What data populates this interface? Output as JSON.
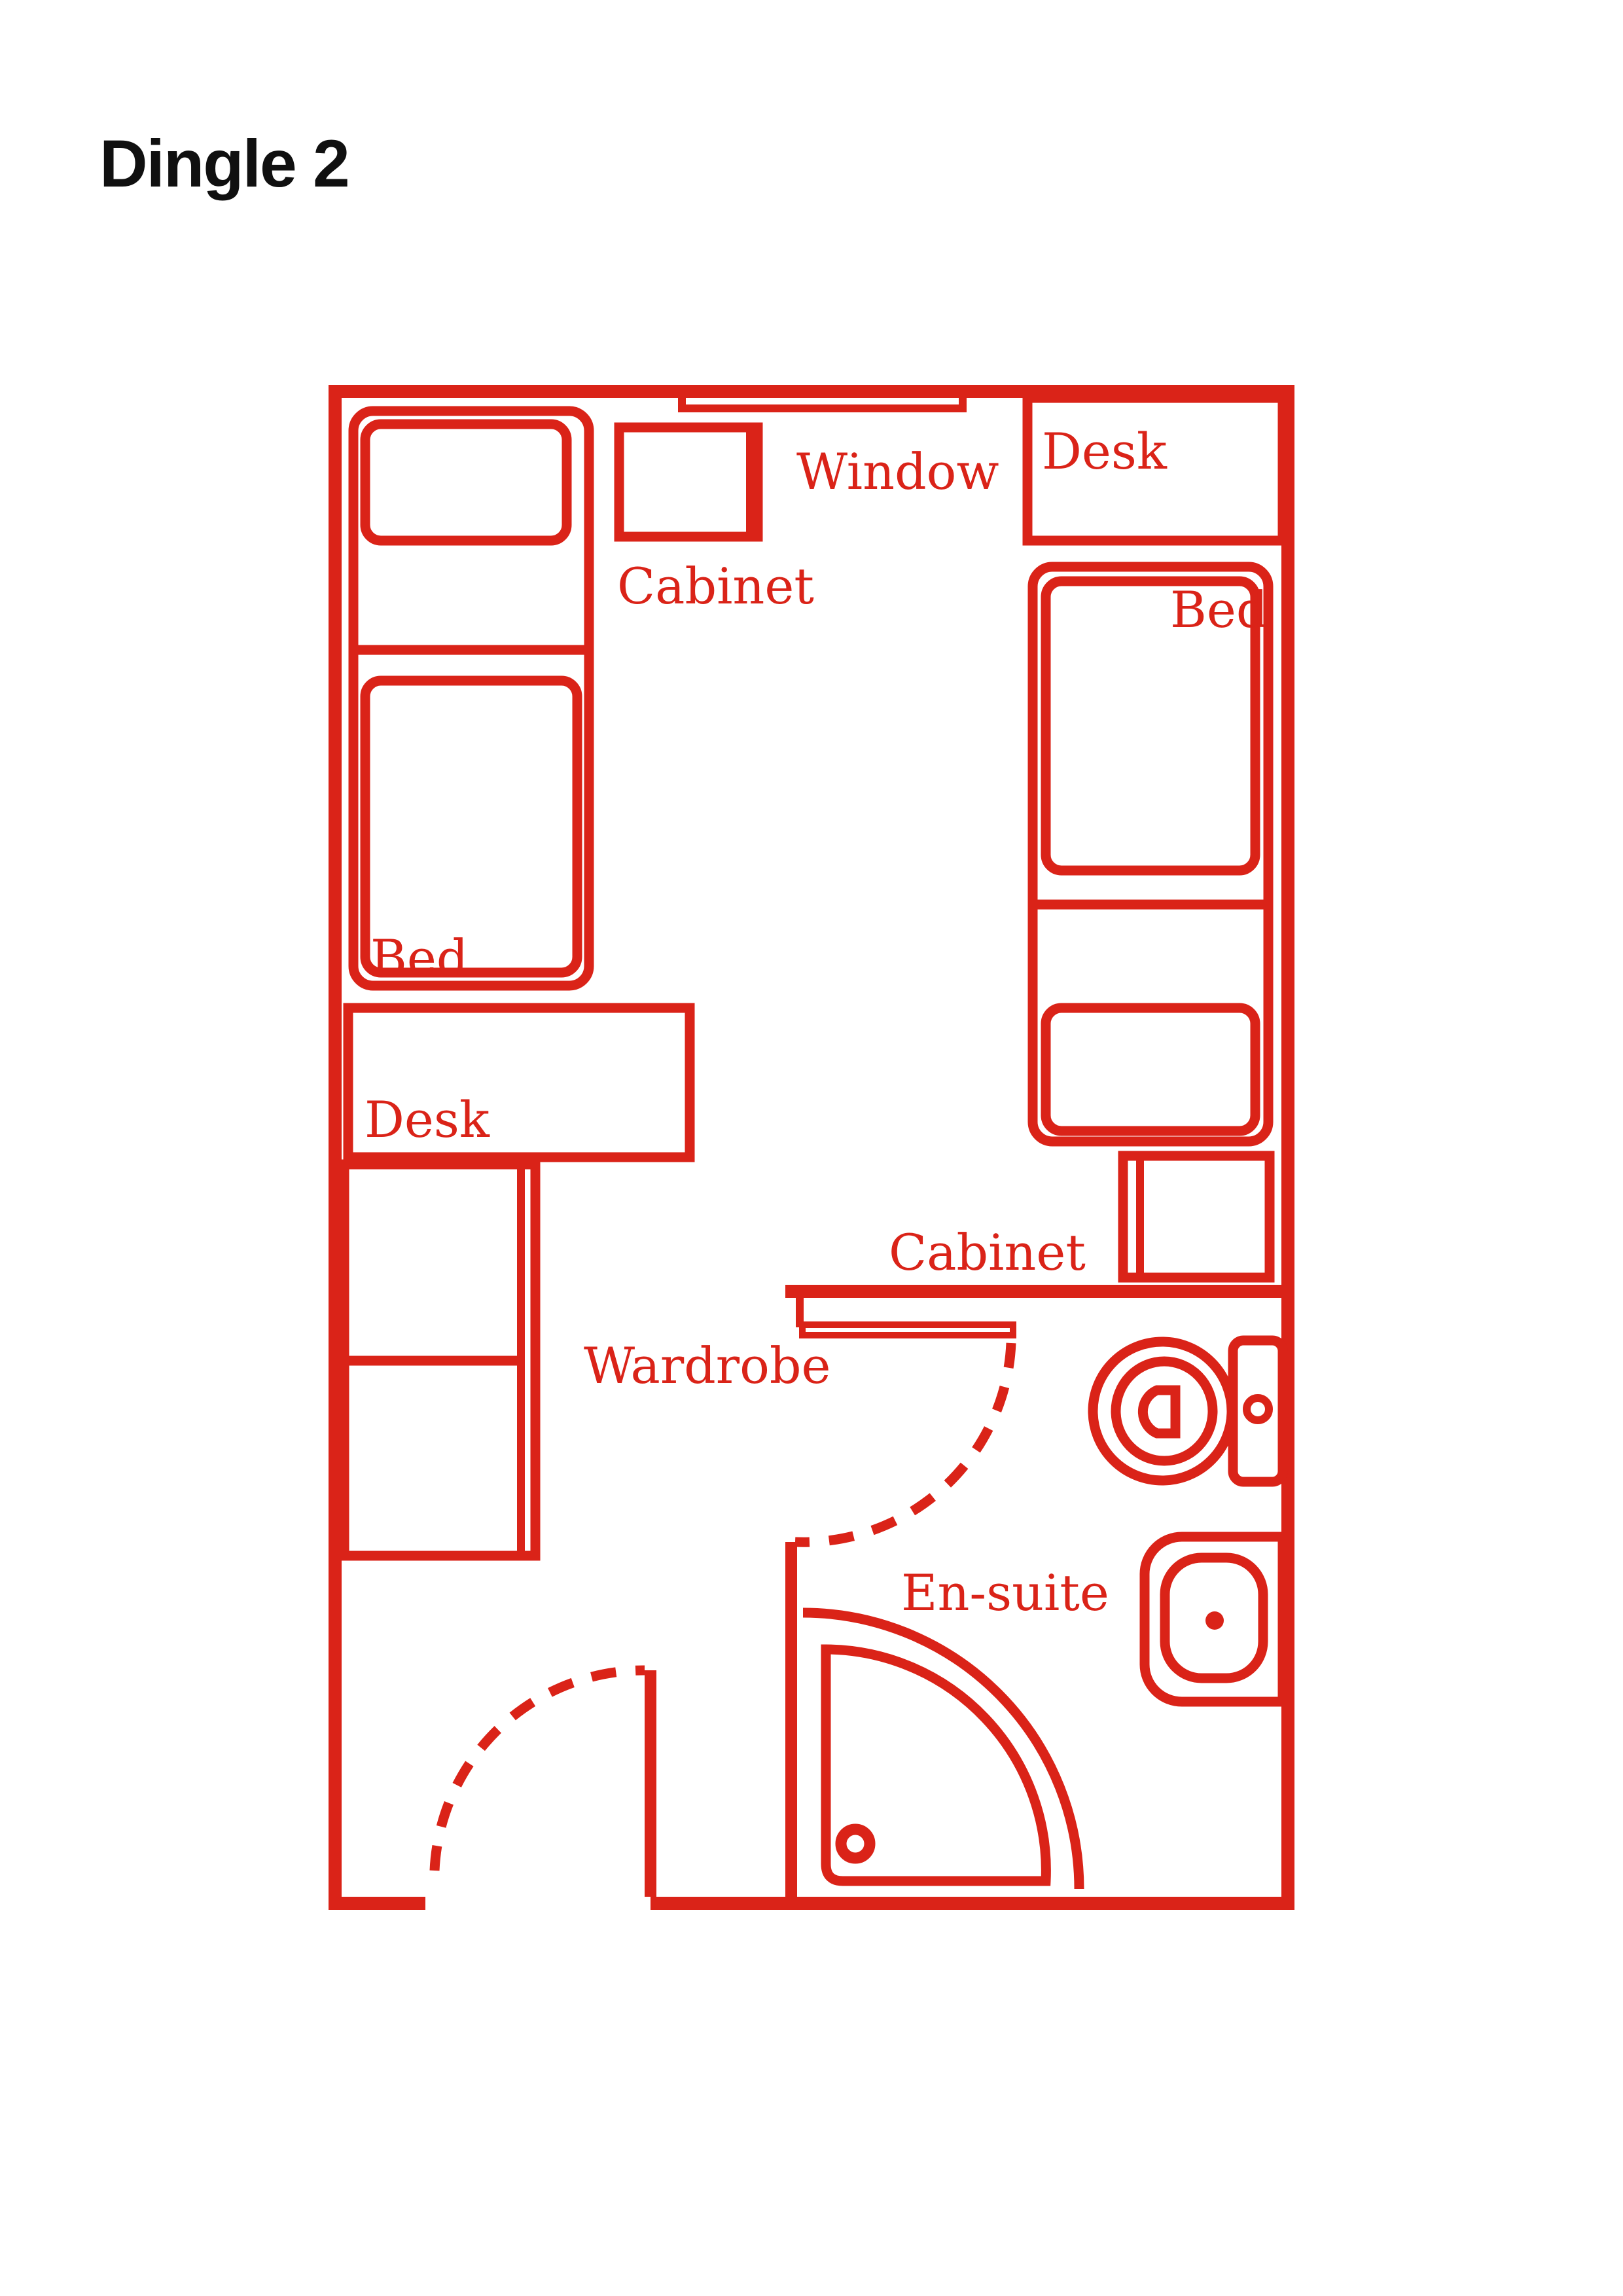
{
  "page": {
    "title": "Dingle 2"
  },
  "floor_plan": {
    "labels": {
      "window": "Window",
      "cabinet_top": "Cabinet",
      "desk_right": "Desk",
      "bed_right": "Bed",
      "bed_left": "Bed",
      "desk_left": "Desk",
      "wardrobe": "Wardrobe",
      "cabinet_ensuite": "Cabinet",
      "ensuite": "En-suite"
    },
    "colors": {
      "plan": "#DA2318",
      "title": "#101010",
      "background": "#FFFFFF"
    }
  }
}
